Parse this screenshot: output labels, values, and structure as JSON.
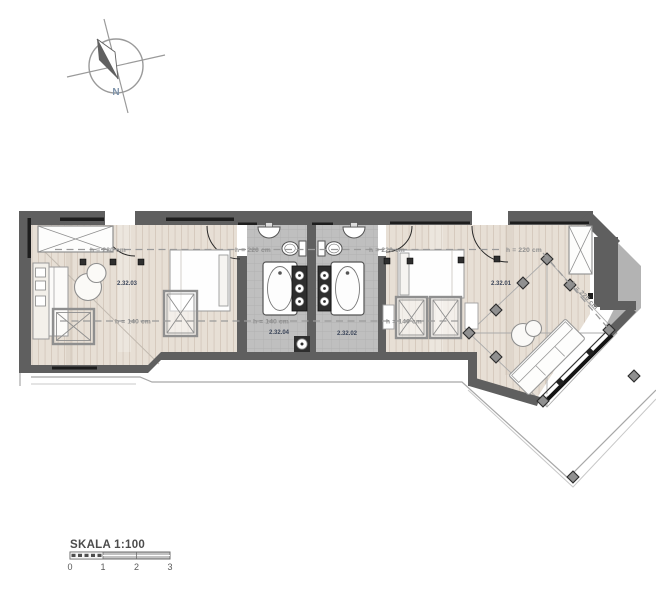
{
  "compass": {
    "north_label": "N"
  },
  "rooms": [
    {
      "number": "2.32.03"
    },
    {
      "number": "2.32.04"
    },
    {
      "number": "2.32.02"
    },
    {
      "number": "2.32.01"
    }
  ],
  "height_labels": {
    "h220_room_left": "h = 220 cm",
    "h220_bath_left": "h = 220 cm",
    "h220_bath_right": "h = 220 cm",
    "h220_room_right": "h = 220 cm",
    "h220_diagonal": "h = 220 cm",
    "h140_room_left": "h = 140 cm",
    "h140_bath_left": "h = 140 cm",
    "h140_room_right": "h = 140 cm"
  },
  "scale_bar": {
    "title": "SKALA 1:100",
    "ticks": [
      "0",
      "1",
      "2",
      "3"
    ]
  },
  "colors": {
    "wall": "#5f5f5f",
    "wood_floor": "#e7dfd5",
    "wood_plank_line": "#d3c7ba",
    "tile_floor": "#bfbfbf",
    "tile_grid": "#aeaeae",
    "dash": "#9a9a9a",
    "accent_label": "#3c465a",
    "fixture_stroke": "#555555",
    "furniture_stroke": "#8f8f8f"
  }
}
